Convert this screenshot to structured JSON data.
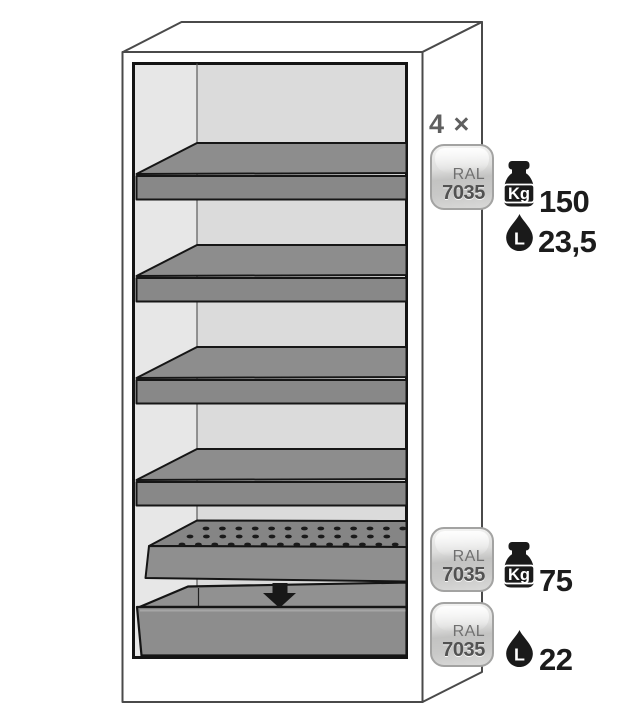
{
  "annotations": {
    "multiplier": "4 ×",
    "badges": [
      {
        "ral": "RAL",
        "code": "7035"
      },
      {
        "ral": "RAL",
        "code": "7035"
      },
      {
        "ral": "RAL",
        "code": "7035"
      }
    ],
    "specs": [
      {
        "icon": "weight-kg-icon",
        "unit": "Kg",
        "value": "150"
      },
      {
        "icon": "liquid-drop-icon",
        "unit": "L",
        "value": "23,5"
      },
      {
        "icon": "weight-kg-icon",
        "unit": "Kg",
        "value": "75"
      },
      {
        "icon": "liquid-drop-icon",
        "unit": "L",
        "value": "22"
      }
    ]
  },
  "illustration": {
    "shelf_count": 4,
    "parts": [
      "shelf-tray",
      "perforated-insert",
      "bottom-sump",
      "down-arrow-icon"
    ]
  },
  "colors": {
    "background": "#ffffff",
    "outline": "#4a4a4a",
    "interior_back_wall": "#dbdbdb",
    "interior_side_wall": "#e7e7e7",
    "tray_gray": "#8d8d8d",
    "tray_front_gray": "#888888",
    "badge_border": "#a3a3a2",
    "icon_black": "#1a1a1a"
  }
}
